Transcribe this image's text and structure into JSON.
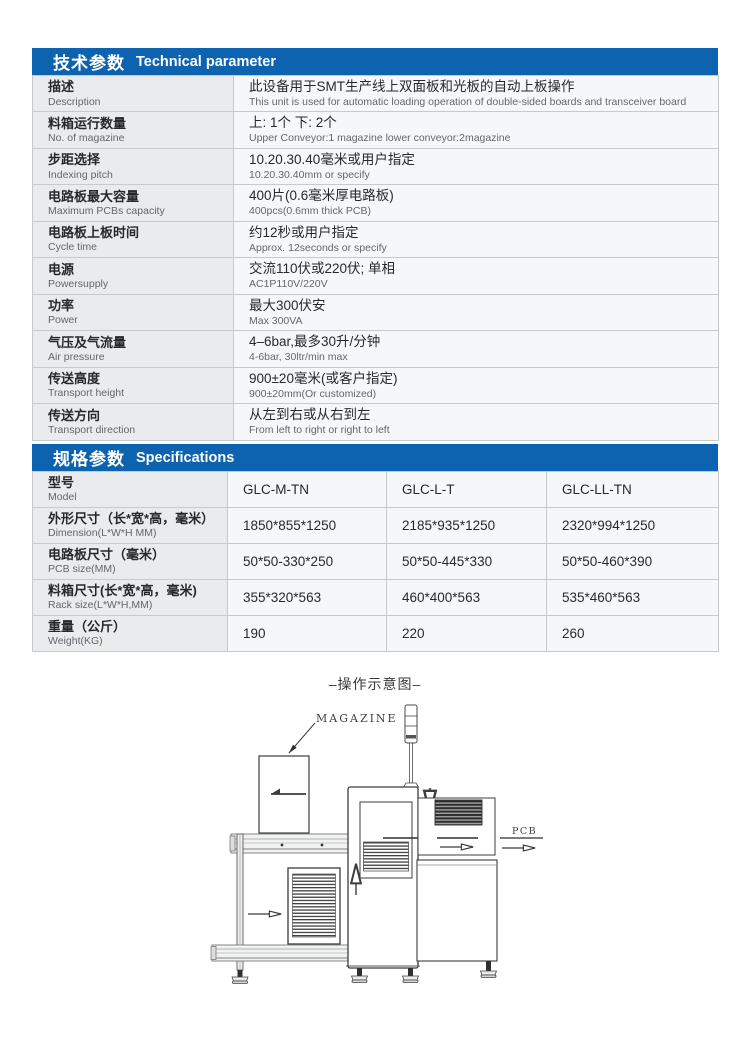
{
  "colors": {
    "header_blue": "#0e63b0",
    "label_cell_bg": "#e9ebed",
    "value_cell_bg": "#f6f7f8",
    "table_border": "#c6cacd",
    "text_dark": "#26292c",
    "text_gray": "#63676b",
    "diagram_line": "#3c3c3c"
  },
  "technical": {
    "title_cn": "技术参数",
    "title_en": "Technical parameter",
    "rows": [
      {
        "label_cn": "描述",
        "label_en": "Description",
        "value_cn": "此设备用于SMT生产线上双面板和光板的自动上板操作",
        "value_en": "This unit is used for automatic loading operation of double-sided boards and transceiver board"
      },
      {
        "label_cn": "料箱运行数量",
        "label_en": "No. of magazine",
        "value_cn": "上: 1个  下: 2个",
        "value_en": "Upper Conveyor:1 magazine lower conveyor:2magazine"
      },
      {
        "label_cn": "步距选择",
        "label_en": "Indexing pitch",
        "value_cn": "10.20.30.40毫米或用户指定",
        "value_en": "10.20.30.40mm or specify"
      },
      {
        "label_cn": "电路板最大容量",
        "label_en": "Maximum PCBs capacity",
        "value_cn": "400片(0.6毫米厚电路板)",
        "value_en": "400pcs(0.6mm thick PCB)"
      },
      {
        "label_cn": "电路板上板时间",
        "label_en": "Cycle time",
        "value_cn": "约12秒或用户指定",
        "value_en": "Approx. 12seconds or specify"
      },
      {
        "label_cn": "电源",
        "label_en": "Powersupply",
        "value_cn": "交流110伏或220伏; 单相",
        "value_en": "AC1P110V/220V"
      },
      {
        "label_cn": "功率",
        "label_en": "Power",
        "value_cn": "最大300伏安",
        "value_en": "Max 300VA"
      },
      {
        "label_cn": "气压及气流量",
        "label_en": "Air pressure",
        "value_cn": "4–6bar,最多30升/分钟",
        "value_en": "4-6bar, 30ltr/min max"
      },
      {
        "label_cn": "传送高度",
        "label_en": "Transport height",
        "value_cn": "900±20毫米(或客户指定)",
        "value_en": "900±20mm(Or customized)"
      },
      {
        "label_cn": "传送方向",
        "label_en": "Transport direction",
        "value_cn": "从左到右或从右到左",
        "value_en": "From left to right or right to left"
      }
    ]
  },
  "specifications": {
    "title_cn": "规格参数",
    "title_en": "Specifications",
    "rows": [
      {
        "label_cn": "型号",
        "label_en": "Model",
        "v1": "GLC-M-TN",
        "v2": "GLC-L-T",
        "v3": "GLC-LL-TN"
      },
      {
        "label_cn": "外形尺寸（长*宽*高，毫米）",
        "label_en": "Dimension(L*W*H MM)",
        "v1": "1850*855*1250",
        "v2": "2185*935*1250",
        "v3": "2320*994*1250"
      },
      {
        "label_cn": "电路板尺寸（毫米）",
        "label_en": "PCB size(MM)",
        "v1": "50*50-330*250",
        "v2": "50*50-445*330",
        "v3": "50*50-460*390"
      },
      {
        "label_cn": "料箱尺寸(长*宽*高，毫米)",
        "label_en": "Rack size(L*W*H,MM)",
        "v1": "355*320*563",
        "v2": "460*400*563",
        "v3": "535*460*563"
      },
      {
        "label_cn": "重量（公斤）",
        "label_en": "Weight(KG)",
        "v1": "190",
        "v2": "220",
        "v3": "260"
      }
    ]
  },
  "diagram": {
    "title": "–操作示意图–",
    "magazine_label": "MAGAZINE",
    "pcb_label": "PCB"
  }
}
